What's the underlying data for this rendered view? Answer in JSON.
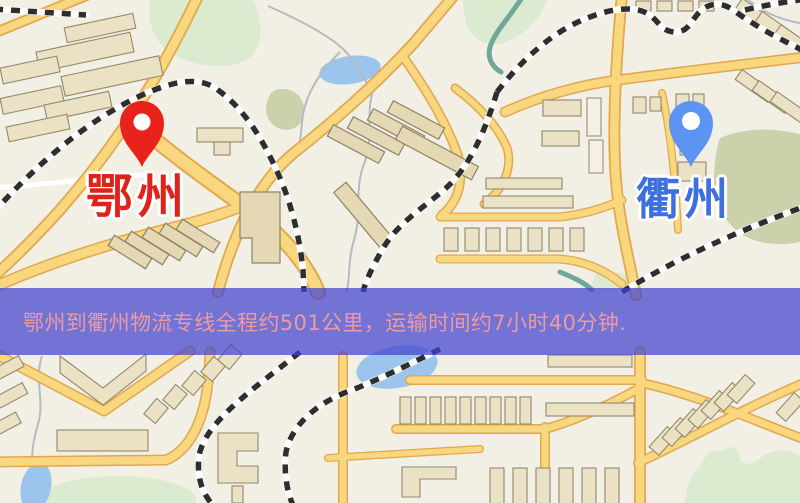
{
  "map": {
    "origin_marker": {
      "label": "鄂州",
      "pin_color": "#e8231c",
      "label_color": "#df221a"
    },
    "destination_marker": {
      "label": "衢州",
      "pin_color": "#5d94f3",
      "label_color": "#3e6fe0"
    },
    "palette": {
      "land": "#f2efe5",
      "road_fill": "#f8d77e",
      "road_casing": "#e2a74f",
      "water": "#9cc5ee",
      "park_green": "#dcead0",
      "olive_green": "#cbd2ab",
      "railway": "#2e2e2e",
      "building": "#ebe2c6",
      "building_outline": "#93886c"
    }
  },
  "banner": {
    "text": "鄂州到衢州物流专线全程约501公里，运输时间约7小时40分钟.",
    "background_color": "rgba(64,66,206,0.72)",
    "text_color": "#ee9a9e"
  }
}
